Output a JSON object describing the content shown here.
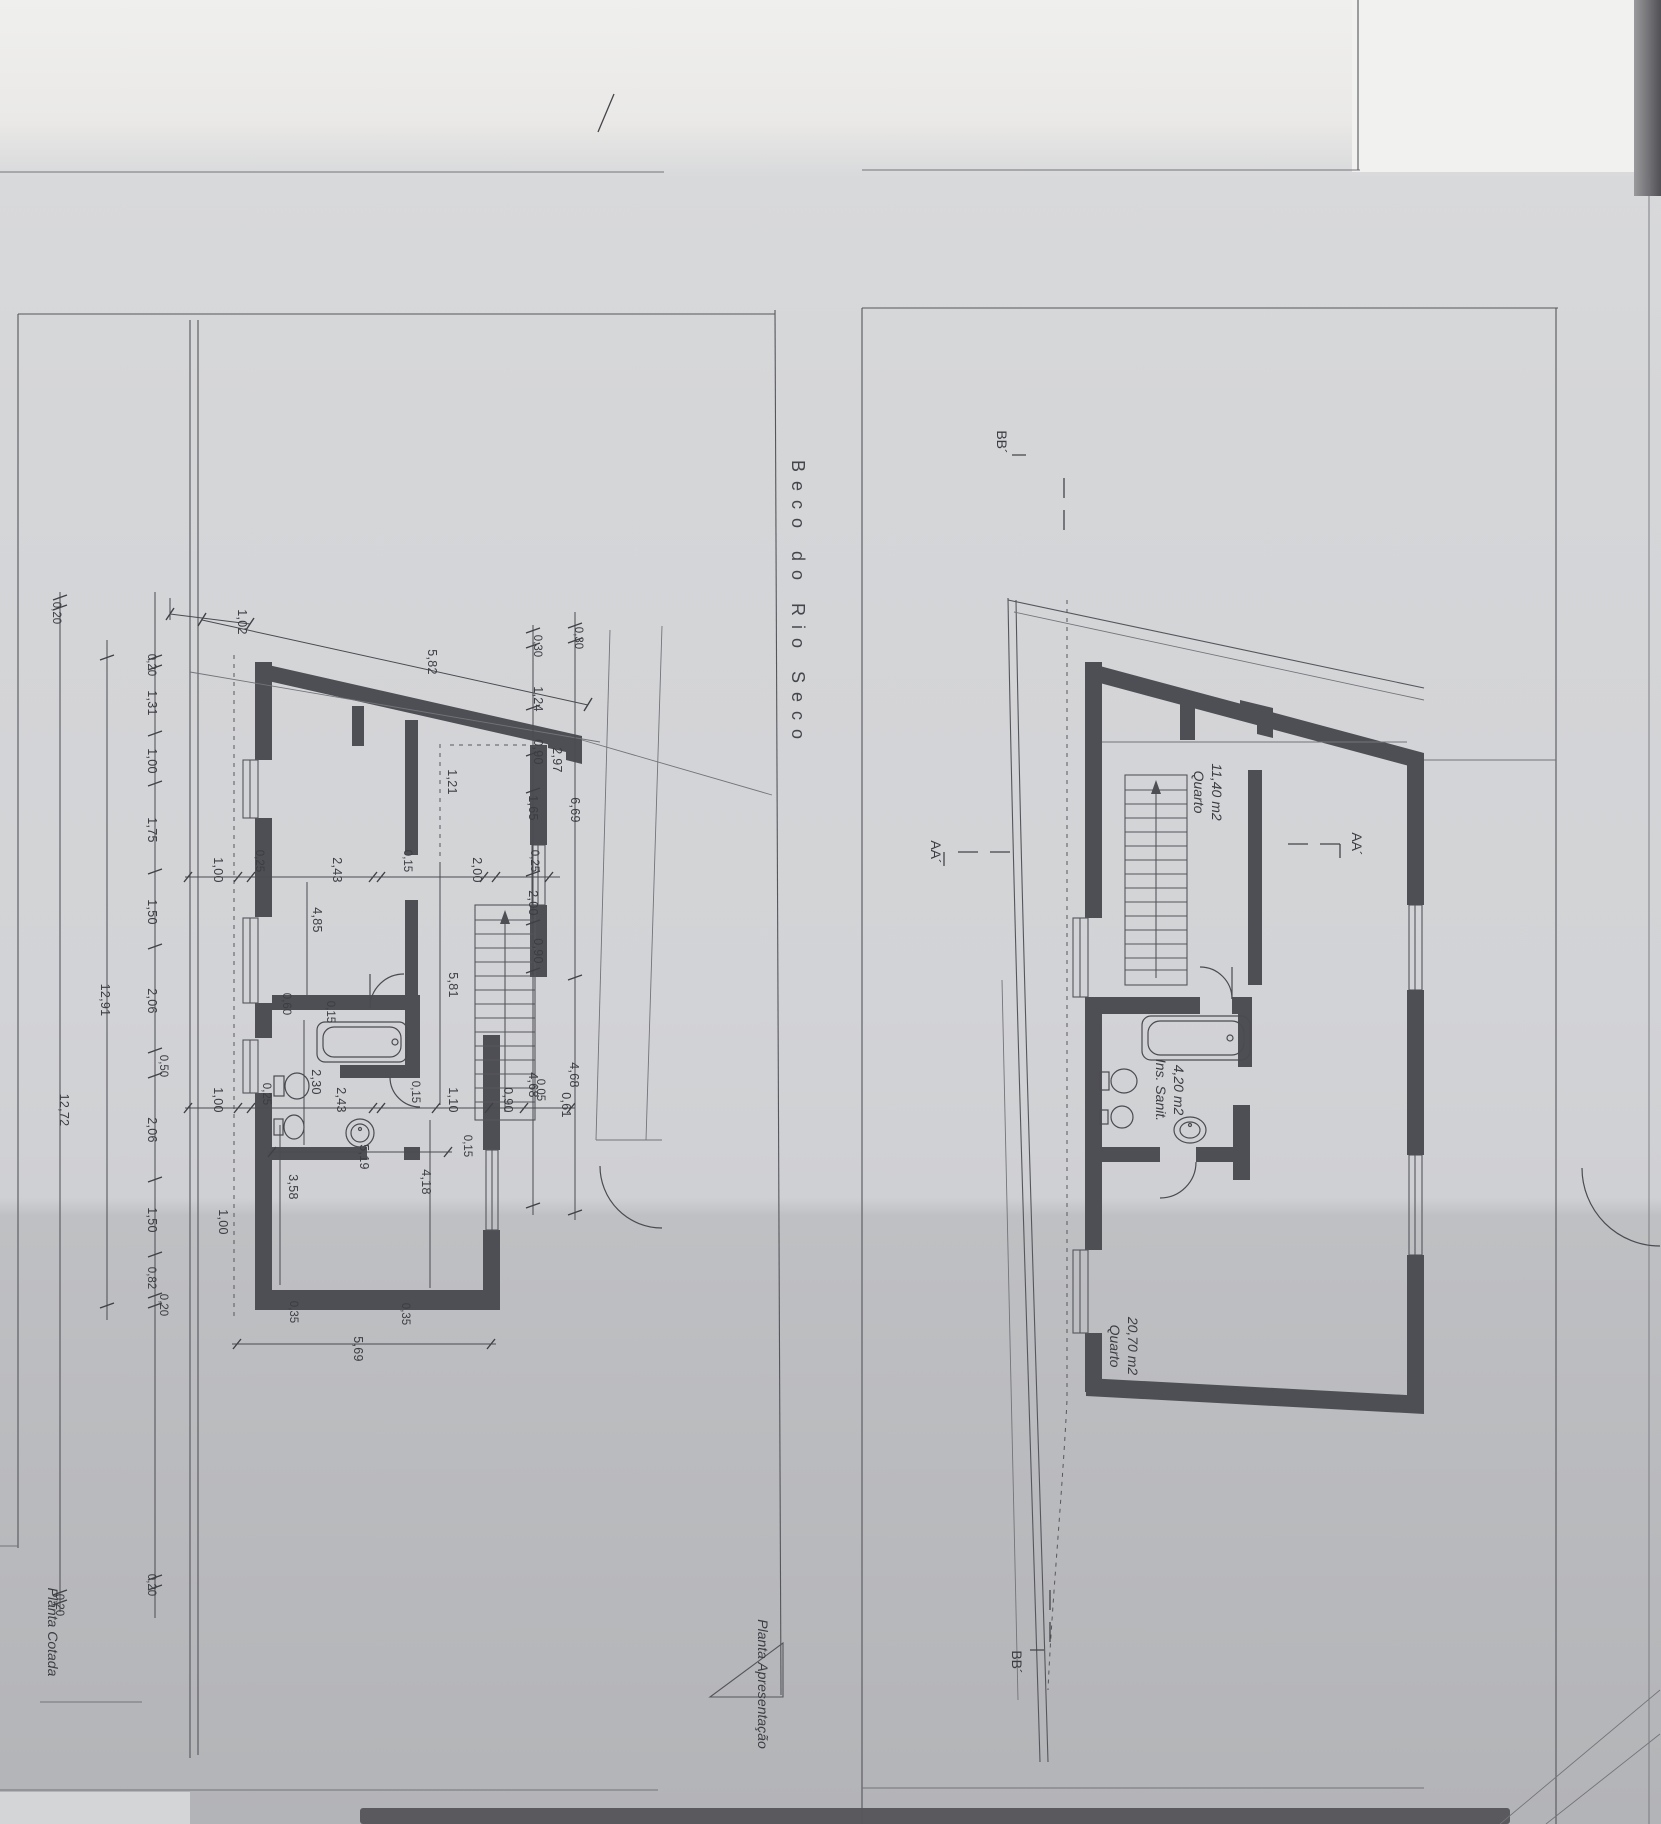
{
  "street_name": "Beco do Rio Seco",
  "plans": {
    "cotada": {
      "caption": "Planta Cotada",
      "dims": {
        "top": [
          "1,02",
          "5,82"
        ],
        "chain_inner": [
          "0,20",
          "1,31",
          "1,00",
          "1,75",
          "1,50",
          "2,06",
          "0,50",
          "2,06",
          "1,50",
          "0,82",
          "0,20"
        ],
        "total_inner": "12,91",
        "outer_top": "0,20",
        "total_outer": "12,72",
        "bottom_left": [
          "0,20",
          "0,20"
        ],
        "row_upper": [
          "1,00",
          "0,25",
          "4,85",
          "2,43",
          "0,15",
          "2,00",
          "0,25"
        ],
        "row_lower": [
          "1,00",
          "0,25",
          "2,43",
          "0,15",
          "1,10",
          "0,90",
          "0,05",
          "0,61"
        ],
        "right_a": [
          "0,30",
          "1,24",
          "0,90",
          "1,65",
          "2,00",
          "0,90",
          "4,68"
        ],
        "right_b": [
          "0,30",
          "6,69",
          "4,68"
        ],
        "right_c": "2,97",
        "vert": [
          "1,21",
          "5,81",
          "2,30",
          "0,15",
          "0,15",
          "0,60"
        ],
        "bottom_room": [
          "5,19",
          "4,18",
          "3,58"
        ],
        "bottom": [
          "0,35",
          "0,35",
          "5,69"
        ],
        "extra": [
          "1,00"
        ]
      }
    },
    "apresentacao": {
      "caption": "Planta Apresentação",
      "rooms": [
        {
          "name": "Quarto",
          "area": "11,40 m2"
        },
        {
          "name": "Ins. Sanit.",
          "area": "4,20 m2"
        },
        {
          "name": "Quarto",
          "area": "20,70 m2"
        }
      ],
      "markers": {
        "aa": "AA´",
        "bb": "BB´"
      }
    }
  }
}
